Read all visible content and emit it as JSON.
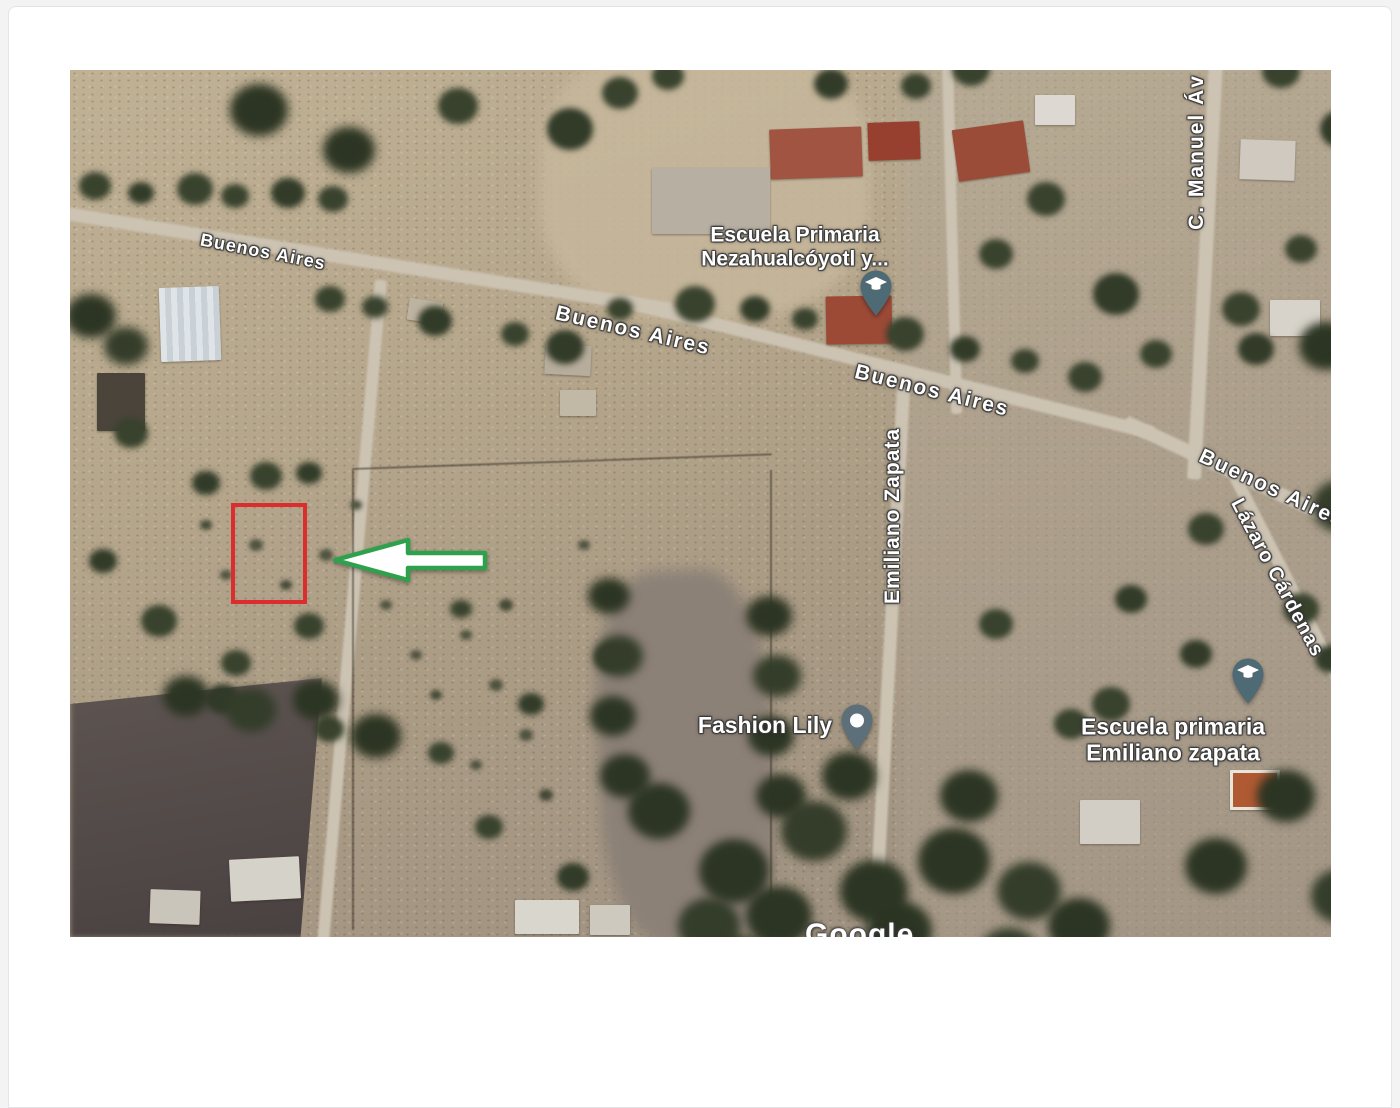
{
  "map": {
    "streets": {
      "buenos_aires": "Buenos Aires",
      "c_manuel": "C. Manuel Áv",
      "emiliano_zapata": "Emiliano Zapata",
      "lazaro_cardenas": "Lázaro Cárdenas"
    },
    "places": {
      "school_1": {
        "line1": "Escuela Primaria",
        "line2": "Nezahualcóyotl y..."
      },
      "store": {
        "name": "Fashion Lily"
      },
      "school_2": {
        "line1": "Escuela primaria",
        "line2": "Emiliano zapata"
      }
    },
    "pins": {
      "school_1": "school-pin",
      "store": "store-pin",
      "school_2": "school-pin"
    },
    "watermark": "Google",
    "colors": {
      "highlight_box": "#db2d2d",
      "arrow_stroke": "#2fa14c",
      "arrow_fill": "#ffffff",
      "pin_school": "#4e6b75",
      "pin_store": "#5d6f79"
    }
  }
}
